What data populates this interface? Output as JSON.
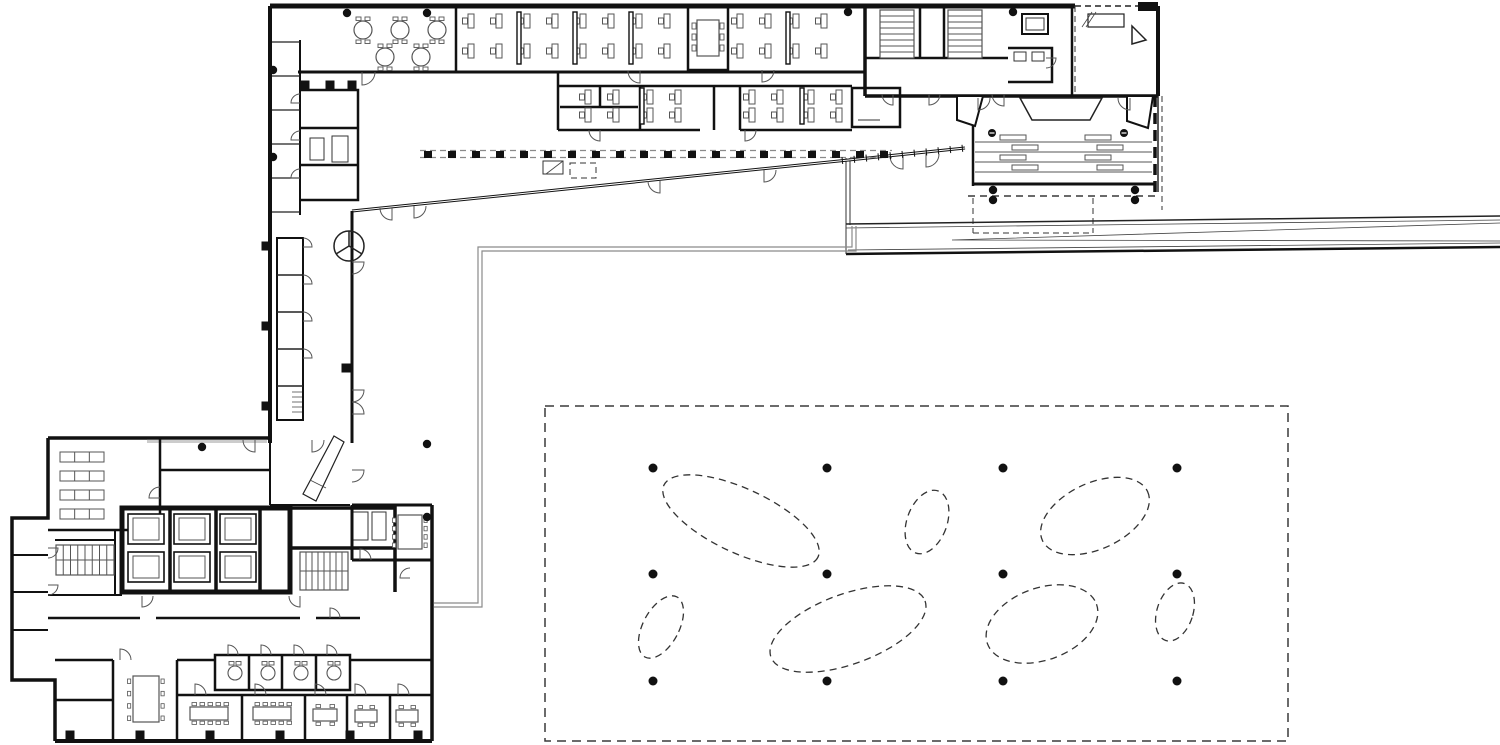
{
  "document": {
    "kind": "architectural-floor-plan",
    "aria_label": "Black-and-white architectural ground floor plan: L-shaped office building with open-plan desks, auditorium with tiered seating, elevator cores, stairs, and a courtyard planting grid of dashed ellipses and structural columns"
  },
  "canvas": {
    "width": 1500,
    "height": 745,
    "background": "#ffffff"
  },
  "palette": {
    "wall": "#111111",
    "medium": "#333333",
    "thin": "#555555",
    "gray": "#8a8a8a",
    "paper": "#ffffff"
  },
  "courtyard": {
    "rect": {
      "x": 545,
      "y": 406,
      "w": 743,
      "h": 335
    },
    "rect_dash": "9 6",
    "ellipse_dash": "7 5",
    "column_grid": {
      "xs": [
        653,
        827,
        1003,
        1177
      ],
      "ys": [
        468,
        574,
        681
      ],
      "r": 4.5
    },
    "tree_ellipses": [
      {
        "cx": 741,
        "cy": 521,
        "rx": 85,
        "ry": 32,
        "rot": 25
      },
      {
        "cx": 927,
        "cy": 522,
        "rx": 20,
        "ry": 33,
        "rot": 20
      },
      {
        "cx": 1095,
        "cy": 516,
        "rx": 58,
        "ry": 33,
        "rot": -25
      },
      {
        "cx": 661,
        "cy": 627,
        "rx": 18,
        "ry": 34,
        "rot": 28
      },
      {
        "cx": 848,
        "cy": 629,
        "rx": 82,
        "ry": 35,
        "rot": -20
      },
      {
        "cx": 1042,
        "cy": 624,
        "rx": 58,
        "ry": 36,
        "rot": -20
      },
      {
        "cx": 1175,
        "cy": 612,
        "rx": 18,
        "ry": 30,
        "rot": 18
      }
    ]
  },
  "structural_columns": {
    "dot_r": 4.2,
    "dots": [
      [
        347,
        13
      ],
      [
        427,
        13
      ],
      [
        848,
        12
      ],
      [
        1013,
        12
      ],
      [
        273,
        70
      ],
      [
        273,
        157
      ],
      [
        427,
        444
      ],
      [
        427,
        517
      ],
      [
        202,
        447
      ],
      [
        993,
        190
      ],
      [
        993,
        200
      ],
      [
        1135,
        190
      ],
      [
        1135,
        200
      ]
    ],
    "square_size": 9,
    "squares": [
      [
        266,
        246
      ],
      [
        266,
        326
      ],
      [
        266,
        406
      ],
      [
        346,
        368
      ],
      [
        70,
        735
      ],
      [
        140,
        735
      ],
      [
        210,
        735
      ],
      [
        280,
        735
      ],
      [
        350,
        735
      ],
      [
        418,
        735
      ],
      [
        305,
        85
      ],
      [
        330,
        85
      ],
      [
        352,
        85
      ]
    ]
  },
  "door_closers": [
    [
      992,
      133
    ],
    [
      1124,
      133
    ]
  ],
  "top_wing": {
    "desk": {
      "w": 6,
      "h": 14,
      "chair_w": 5,
      "chair_h": 6
    },
    "desk_rows": [
      {
        "y": 14,
        "xs": [
          468,
          496,
          524,
          552,
          580,
          608,
          636,
          664,
          737,
          765,
          793,
          821
        ]
      },
      {
        "y": 44,
        "xs": [
          468,
          496,
          524,
          552,
          580,
          608,
          636,
          664,
          737,
          765,
          793,
          821
        ]
      },
      {
        "y": 90,
        "xs": [
          585,
          613,
          647,
          675,
          749,
          777,
          808,
          836
        ]
      },
      {
        "y": 108,
        "xs": [
          585,
          613,
          647,
          675,
          749,
          777,
          808,
          836
        ]
      }
    ],
    "partitions": [
      [
        517,
        12,
        4,
        52
      ],
      [
        573,
        12,
        4,
        52
      ],
      [
        629,
        12,
        4,
        52
      ],
      [
        786,
        12,
        4,
        52
      ],
      [
        640,
        88,
        4,
        36
      ],
      [
        800,
        88,
        4,
        36
      ]
    ],
    "round_tables": [
      [
        363,
        30
      ],
      [
        400,
        30
      ],
      [
        437,
        30
      ],
      [
        385,
        57
      ],
      [
        421,
        57
      ]
    ],
    "round_table_r": 9,
    "conference_table": {
      "x": 697,
      "y": 20,
      "w": 22,
      "h": 36
    }
  },
  "track": {
    "x0": 424,
    "y": 151,
    "step": 24,
    "count": 20,
    "sq_w": 8,
    "sq_h": 7,
    "guide_y1": 150.5,
    "guide_y2": 157.5,
    "x_end": 892
  },
  "diagonal_ticks": {
    "x1": 842,
    "y1": 160.5,
    "x2": 962,
    "y2": 148.3,
    "n": 11,
    "len": 7
  },
  "auditorium": {
    "row_lines": {
      "x1": 975,
      "x2": 1152,
      "ys": [
        142,
        152,
        162,
        172
      ]
    },
    "table_w": 26,
    "table_h": 5,
    "row_tables": [
      [
        1000,
        135
      ],
      [
        1085,
        135
      ],
      [
        1012,
        145
      ],
      [
        1097,
        145
      ],
      [
        1000,
        155
      ],
      [
        1085,
        155
      ],
      [
        1012,
        165
      ],
      [
        1097,
        165
      ]
    ],
    "dash_line": {
      "x1": 968,
      "x2": 1157,
      "y": 196
    }
  },
  "lower_block": {
    "shelf": {
      "w": 44,
      "h": 10,
      "cells": 3
    },
    "shelf_rows": [
      [
        60,
        452
      ],
      [
        60,
        471
      ],
      [
        60,
        490
      ],
      [
        60,
        509
      ]
    ],
    "elevator_cell": {
      "w": 36,
      "h": 30
    },
    "elevator_cells": [
      [
        128,
        514
      ],
      [
        174,
        514
      ],
      [
        220,
        514
      ],
      [
        128,
        552
      ],
      [
        174,
        552
      ],
      [
        220,
        552
      ]
    ],
    "stair_treads": [
      {
        "x": 56,
        "y": 545,
        "w": 58,
        "h": 30,
        "n": 7,
        "dir": "v"
      },
      {
        "x": 300,
        "y": 552,
        "w": 48,
        "h": 38,
        "n": 7,
        "dir": "v"
      },
      {
        "x": 880,
        "y": 10,
        "w": 34,
        "h": 48,
        "n": 7,
        "dir": "h"
      },
      {
        "x": 948,
        "y": 10,
        "w": 34,
        "h": 48,
        "n": 7,
        "dir": "h"
      }
    ],
    "roomette_tables": [
      [
        235,
        673
      ],
      [
        268,
        673
      ],
      [
        301,
        673
      ],
      [
        334,
        673
      ]
    ],
    "roomette_r": 7,
    "long_tables": [
      {
        "x": 133,
        "y": 676,
        "w": 26,
        "h": 46,
        "kind": "tall"
      },
      {
        "x": 190,
        "y": 707,
        "w": 38,
        "h": 13,
        "kind": "wide"
      },
      {
        "x": 253,
        "y": 707,
        "w": 38,
        "h": 13,
        "kind": "wide"
      },
      {
        "x": 313,
        "y": 709,
        "w": 24,
        "h": 12,
        "kind": "small"
      },
      {
        "x": 355,
        "y": 710,
        "w": 22,
        "h": 12,
        "kind": "small"
      },
      {
        "x": 396,
        "y": 710,
        "w": 22,
        "h": 12,
        "kind": "small"
      },
      {
        "x": 398,
        "y": 515,
        "w": 24,
        "h": 34,
        "kind": "tall"
      }
    ]
  },
  "doors": [
    [
      362,
      72,
      13,
      180,
      1
    ],
    [
      640,
      71,
      12,
      180,
      0
    ],
    [
      762,
      70,
      12,
      180,
      1
    ],
    [
      300,
      103,
      9,
      270,
      0
    ],
    [
      300,
      140,
      9,
      270,
      0
    ],
    [
      300,
      178,
      9,
      270,
      0
    ],
    [
      600,
      130,
      11,
      180,
      0
    ],
    [
      745,
      130,
      11,
      180,
      1
    ],
    [
      392,
      208,
      12,
      180,
      0
    ],
    [
      414,
      206,
      12,
      180,
      1
    ],
    [
      660,
      181,
      12,
      180,
      0
    ],
    [
      764,
      170,
      12,
      180,
      1
    ],
    [
      903,
      156,
      13,
      180,
      0
    ],
    [
      926,
      154,
      13,
      180,
      1
    ],
    [
      893,
      94,
      11,
      180,
      0
    ],
    [
      929,
      94,
      11,
      180,
      1
    ],
    [
      1004,
      94,
      12,
      180,
      0
    ],
    [
      1046,
      58,
      10,
      90,
      0
    ],
    [
      978,
      98,
      12,
      180,
      1
    ],
    [
      1130,
      98,
      12,
      180,
      0
    ],
    [
      352,
      262,
      12,
      90,
      0
    ],
    [
      352,
      390,
      12,
      90,
      0
    ],
    [
      352,
      414,
      12,
      90,
      1
    ],
    [
      303,
      247,
      9,
      90,
      1
    ],
    [
      303,
      284,
      9,
      90,
      1
    ],
    [
      303,
      321,
      9,
      90,
      1
    ],
    [
      303,
      358,
      9,
      90,
      1
    ],
    [
      255,
      440,
      12,
      180,
      0
    ],
    [
      312,
      440,
      12,
      180,
      1
    ],
    [
      360,
      560,
      11,
      0,
      0
    ],
    [
      160,
      498,
      11,
      270,
      0
    ],
    [
      142,
      596,
      11,
      180,
      1
    ],
    [
      300,
      596,
      11,
      180,
      0
    ],
    [
      330,
      618,
      10,
      0,
      0
    ],
    [
      228,
      655,
      10,
      0,
      0
    ],
    [
      261,
      655,
      10,
      0,
      0
    ],
    [
      294,
      655,
      10,
      0,
      0
    ],
    [
      327,
      655,
      10,
      0,
      0
    ],
    [
      195,
      695,
      11,
      0,
      0
    ],
    [
      255,
      695,
      11,
      0,
      0
    ],
    [
      315,
      695,
      11,
      0,
      0
    ],
    [
      355,
      695,
      11,
      0,
      0
    ],
    [
      398,
      695,
      11,
      0,
      0
    ],
    [
      120,
      660,
      11,
      0,
      0
    ],
    [
      48,
      548,
      10,
      90,
      0
    ],
    [
      48,
      585,
      10,
      90,
      0
    ],
    [
      352,
      470,
      12,
      90,
      0
    ],
    [
      410,
      578,
      10,
      270,
      0
    ]
  ]
}
